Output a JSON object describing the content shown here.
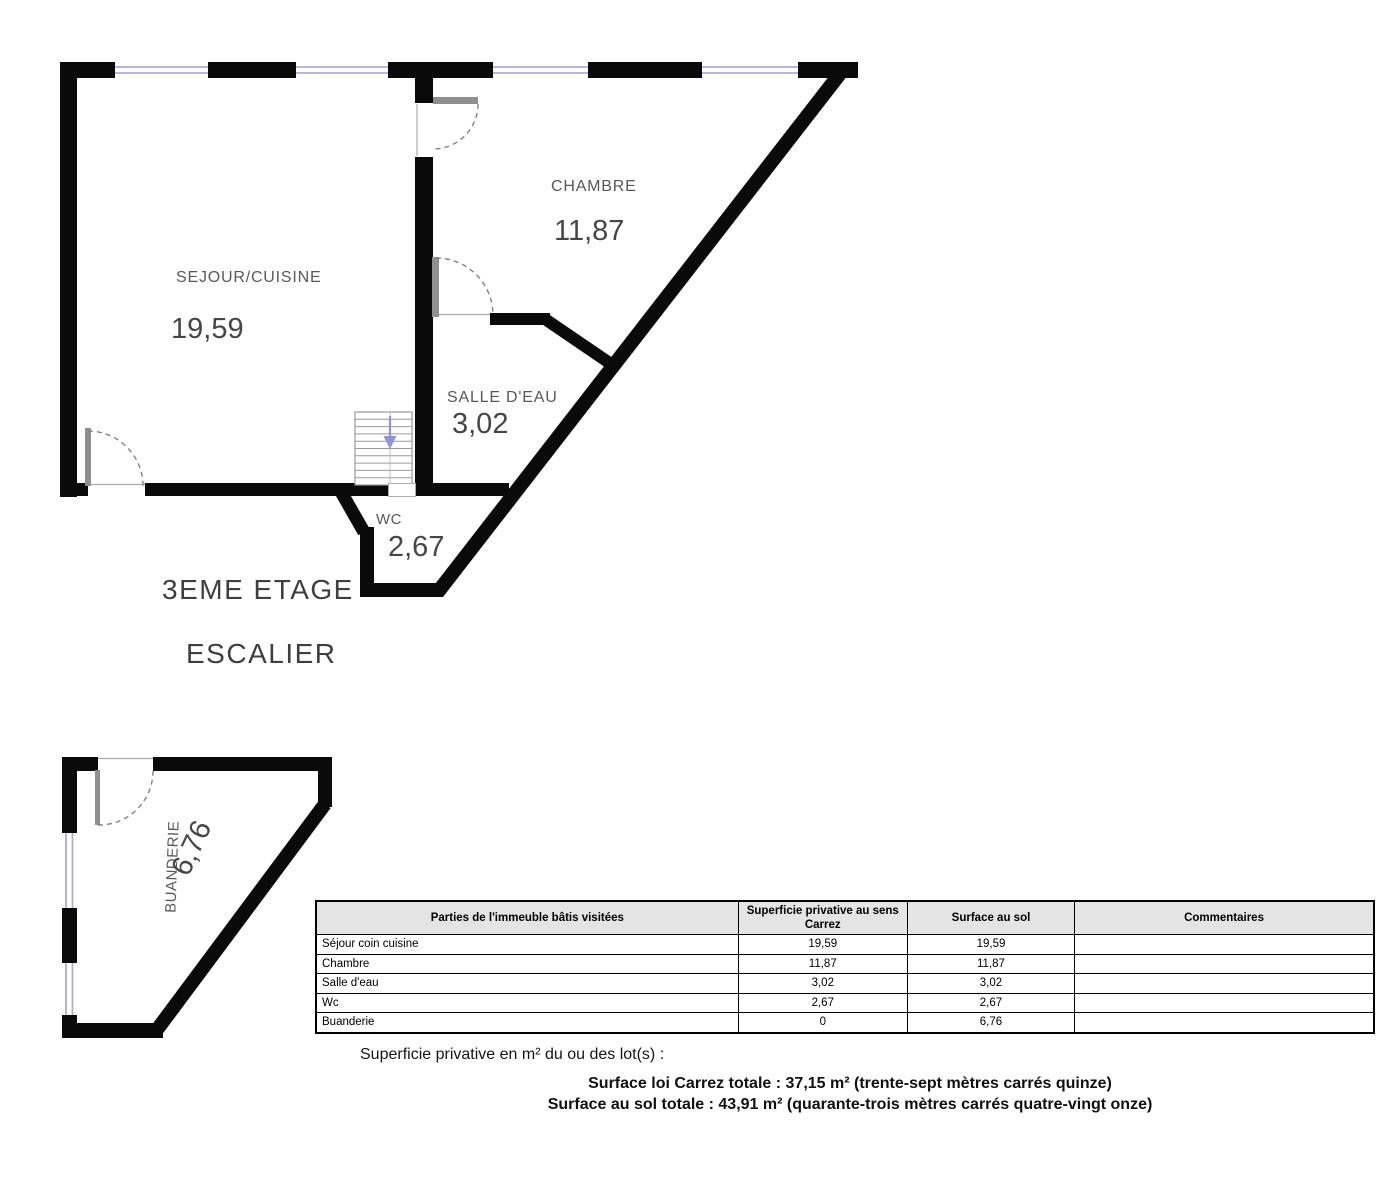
{
  "plan": {
    "title": "3EME ETAGE",
    "subtitle": "ESCALIER",
    "rooms": [
      {
        "name": "SEJOUR/CUISINE",
        "area": "19,59"
      },
      {
        "name": "CHAMBRE",
        "area": "11,87"
      },
      {
        "name": "SALLE D'EAU",
        "area": "3,02"
      },
      {
        "name": "WC",
        "area": "2,67"
      },
      {
        "name": "BUANDERIE",
        "area": "6,76"
      }
    ],
    "colors": {
      "wall": "#0a0a0a",
      "window": "#b2aad6",
      "stair_arrow": "#8f94d6",
      "room_label": "#585858",
      "room_area": "#464646",
      "title": "#3f3f3f"
    }
  },
  "table": {
    "header_bg": "#e4e4e4",
    "headers": [
      "Parties de l'immeuble bâtis visitées",
      "Superficie privative au sens Carrez",
      "Surface au sol",
      "Commentaires"
    ],
    "rows": [
      {
        "label": "Séjour coin cuisine",
        "carrez": "19,59",
        "sol": "19,59",
        "comment": ""
      },
      {
        "label": "Chambre",
        "carrez": "11,87",
        "sol": "11,87",
        "comment": ""
      },
      {
        "label": "Salle d'eau",
        "carrez": "3,02",
        "sol": "3,02",
        "comment": ""
      },
      {
        "label": "Wc",
        "carrez": "2,67",
        "sol": "2,67",
        "comment": ""
      },
      {
        "label": "Buanderie",
        "carrez": "0",
        "sol": "6,76",
        "comment": ""
      }
    ]
  },
  "summary": {
    "intro": "Superficie privative en m² du ou des lot(s) :",
    "carrez_total": "Surface loi Carrez totale : 37,15 m² (trente-sept mètres carrés quinze)",
    "sol_total": "Surface au sol totale : 43,91 m² (quarante-trois mètres carrés quatre-vingt onze)"
  }
}
